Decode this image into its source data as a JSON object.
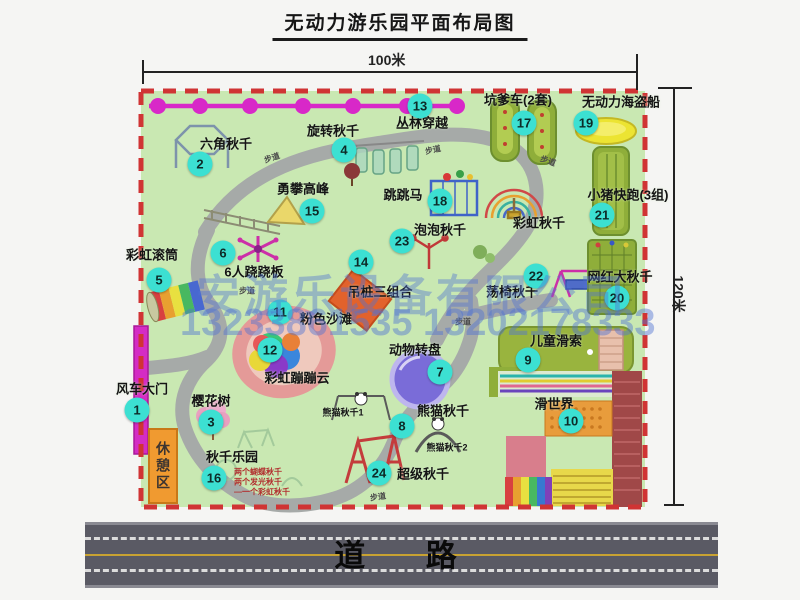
{
  "title": "无动力游乐园平面布局图",
  "dimensions": {
    "top": "100米",
    "right": "120米"
  },
  "road": {
    "label": "道 路"
  },
  "watermark": {
    "company": "安游乐设备有限公司",
    "phone": "13233861535 13202178333"
  },
  "rest_area_label": "休憩区",
  "swing_park_notes": [
    "两个蝴蝶秋千",
    "两个发光秋千",
    "一个彩虹秋千"
  ],
  "extra_labels": [
    {
      "text": "彩虹秋千",
      "x": 539,
      "y": 222
    },
    {
      "text": "熊猫秋千1",
      "x": 343,
      "y": 412
    },
    {
      "text": "熊猫秋千2",
      "x": 447,
      "y": 447
    }
  ],
  "path_labels": [
    {
      "text": "步道",
      "x": 272,
      "y": 158,
      "rot": -18
    },
    {
      "text": "步道",
      "x": 433,
      "y": 150,
      "rot": -12
    },
    {
      "text": "步道",
      "x": 548,
      "y": 161,
      "rot": 20
    },
    {
      "text": "步道",
      "x": 247,
      "y": 291,
      "rot": 0
    },
    {
      "text": "步道",
      "x": 463,
      "y": 322,
      "rot": 0
    },
    {
      "text": "步道",
      "x": 378,
      "y": 497,
      "rot": -8
    }
  ],
  "attractions": [
    {
      "num": "1",
      "label": "风车大门",
      "bx": 137,
      "by": 410,
      "lx": 142,
      "ly": 388
    },
    {
      "num": "2",
      "label": "六角秋千",
      "bx": 200,
      "by": 164,
      "lx": 226,
      "ly": 143
    },
    {
      "num": "3",
      "label": "樱花树",
      "bx": 211,
      "by": 422,
      "lx": 211,
      "ly": 400
    },
    {
      "num": "4",
      "label": "旋转秋千",
      "bx": 344,
      "by": 150,
      "lx": 333,
      "ly": 130
    },
    {
      "num": "5",
      "label": "彩虹滚筒",
      "bx": 159,
      "by": 280,
      "lx": 152,
      "ly": 254
    },
    {
      "num": "6",
      "label": "6人跷跷板",
      "bx": 223,
      "by": 253,
      "lx": 254,
      "ly": 271
    },
    {
      "num": "7",
      "label": "动物转盘",
      "bx": 440,
      "by": 372,
      "lx": 415,
      "ly": 349
    },
    {
      "num": "8",
      "label": "熊猫秋千",
      "bx": 402,
      "by": 426,
      "lx": 443,
      "ly": 410
    },
    {
      "num": "9",
      "label": "儿童滑索",
      "bx": 528,
      "by": 360,
      "lx": 556,
      "ly": 340
    },
    {
      "num": "10",
      "label": "滑世界",
      "bx": 571,
      "by": 421,
      "lx": 554,
      "ly": 403
    },
    {
      "num": "11",
      "label": "粉色沙滩",
      "bx": 280,
      "by": 312,
      "lx": 326,
      "ly": 318
    },
    {
      "num": "12",
      "label": "彩虹蹦蹦云",
      "bx": 270,
      "by": 350,
      "lx": 297,
      "ly": 377
    },
    {
      "num": "13",
      "label": "丛林穿越",
      "bx": 420,
      "by": 106,
      "lx": 422,
      "ly": 122
    },
    {
      "num": "14",
      "label": "吊桩三组合",
      "bx": 361,
      "by": 262,
      "lx": 380,
      "ly": 291
    },
    {
      "num": "15",
      "label": "勇攀高峰",
      "bx": 312,
      "by": 211,
      "lx": 303,
      "ly": 188
    },
    {
      "num": "16",
      "label": "秋千乐园",
      "bx": 214,
      "by": 478,
      "lx": 232,
      "ly": 456
    },
    {
      "num": "17",
      "label": "坑爹车(2套)",
      "bx": 524,
      "by": 123,
      "lx": 518,
      "ly": 99
    },
    {
      "num": "18",
      "label": "跳跳马",
      "bx": 440,
      "by": 201,
      "lx": 403,
      "ly": 194
    },
    {
      "num": "19",
      "label": "无动力海盗船",
      "bx": 586,
      "by": 123,
      "lx": 621,
      "ly": 101
    },
    {
      "num": "20",
      "label": "网红大秋千",
      "bx": 617,
      "by": 298,
      "lx": 620,
      "ly": 276
    },
    {
      "num": "21",
      "label": "小猪快跑(3组)",
      "bx": 602,
      "by": 215,
      "lx": 628,
      "ly": 194
    },
    {
      "num": "22",
      "label": "荡椅秋千",
      "bx": 536,
      "by": 276,
      "lx": 512,
      "ly": 291
    },
    {
      "num": "23",
      "label": "泡泡秋千",
      "bx": 402,
      "by": 241,
      "lx": 440,
      "ly": 229
    },
    {
      "num": "24",
      "label": "超级秋千",
      "bx": 379,
      "by": 473,
      "lx": 423,
      "ly": 473
    }
  ],
  "colors": {
    "badge": "#3ce0d2",
    "border_dash": "#d03434",
    "park_green": "#c9e8b2",
    "walkway": "#a6aaa8",
    "magenta": "#d828c8",
    "olive": "#8fae3a",
    "road": "#5a5a64",
    "watermark_blue": "#5073d2"
  }
}
